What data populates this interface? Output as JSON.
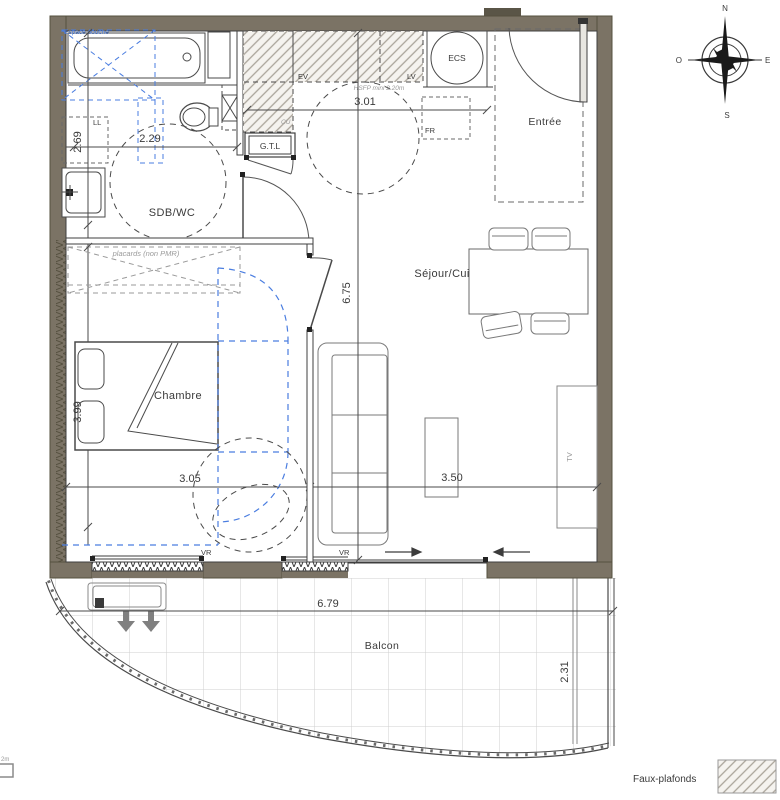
{
  "rooms": {
    "sdb": "SDB/WC",
    "chambre": "Chambre",
    "sejour": "Séjour/Cuisine",
    "entree": "Entrée",
    "balcon": "Balcon"
  },
  "dimensions": {
    "sdb_height": "2.69",
    "sdb_width": "2.29",
    "kitchen_width": "3.01",
    "sejour_height": "6.75",
    "chambre_width": "3.05",
    "sejour_width": "3.50",
    "chambre_height": "3.99",
    "balcon_width": "6.79",
    "balcon_depth": "2.31"
  },
  "annotations": {
    "espace_douche": "Espace douche",
    "ll": "LL",
    "ev": "EV",
    "lv": "LV",
    "cu": "CU",
    "fr": "FR",
    "ecs": "ECS",
    "gtl": "G.T.L",
    "hsfp": "HSFP mini 2.20m",
    "placards": "placards (non PMR)",
    "vr_left": "VR",
    "vr_right": "VR",
    "tv": "TV"
  },
  "compass": {
    "n": "N",
    "s": "S",
    "e": "E",
    "o": "O"
  },
  "legend": {
    "faux_plafonds": "Faux-plafonds"
  },
  "fragment": {
    "clipped": "2m"
  },
  "colors": {
    "wall": "#7b7365",
    "line": "#3f3f3f",
    "accessibility_blue": "#4a7de0",
    "annotation_grey": "#9a9a9a",
    "hatch": "#aaa49a"
  }
}
